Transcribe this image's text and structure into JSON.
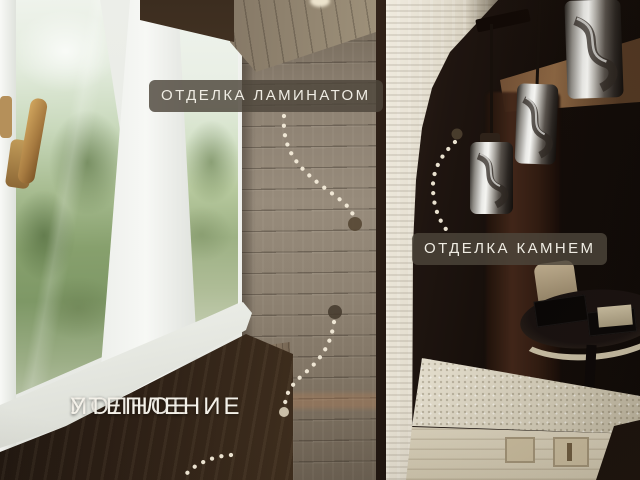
{
  "annotations": {
    "laminate_label": "ОТДЕЛКА ЛАМИНАТОМ",
    "stone_label": "ОТДЕЛКА КАМНЕМ",
    "insulation_label_line1": "ПОЛНОЕ",
    "insulation_label_line2": "УТЕПЛЕНИЕ"
  },
  "colors": {
    "annotation_bg": "rgba(77,69,59,0.82)",
    "annotation_text": "#efece3",
    "dotted_line": "#f4ecda",
    "marker_dot_dark": "#4e4030",
    "marker_dot_light": "#d8cdb7",
    "laminate_wall": "#93887a",
    "stone_cladding": "#ddd6c6",
    "dark_room": "#140d09"
  }
}
